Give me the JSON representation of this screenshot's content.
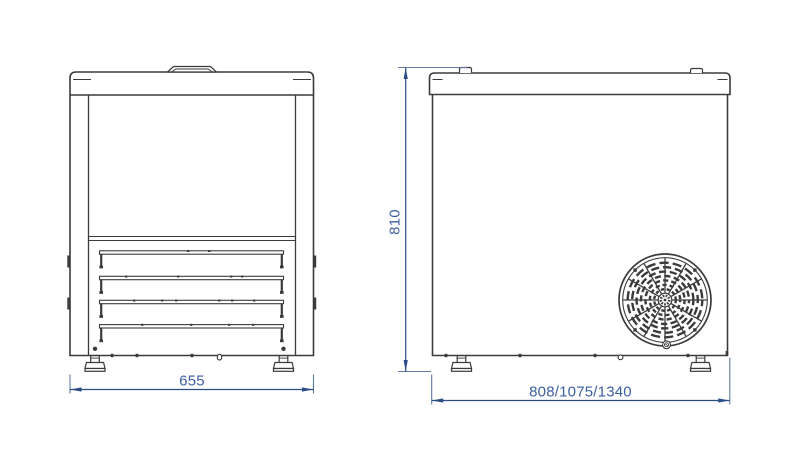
{
  "drawing": {
    "dimension_labels": {
      "front_width": "655",
      "side_height": "810",
      "side_depth": "808/1075/1340"
    },
    "colors": {
      "outline": "#3b3b3b",
      "dimension_line": "#2c4c84",
      "dimension_text": "#3d60a3",
      "extension_line": "#5d7ca6",
      "background": "#ffffff"
    },
    "icons": {
      "fan_grille": "circular-fan-guard",
      "lid_handle": "trapezoid-handle",
      "feet": "adjustable-foot"
    }
  }
}
